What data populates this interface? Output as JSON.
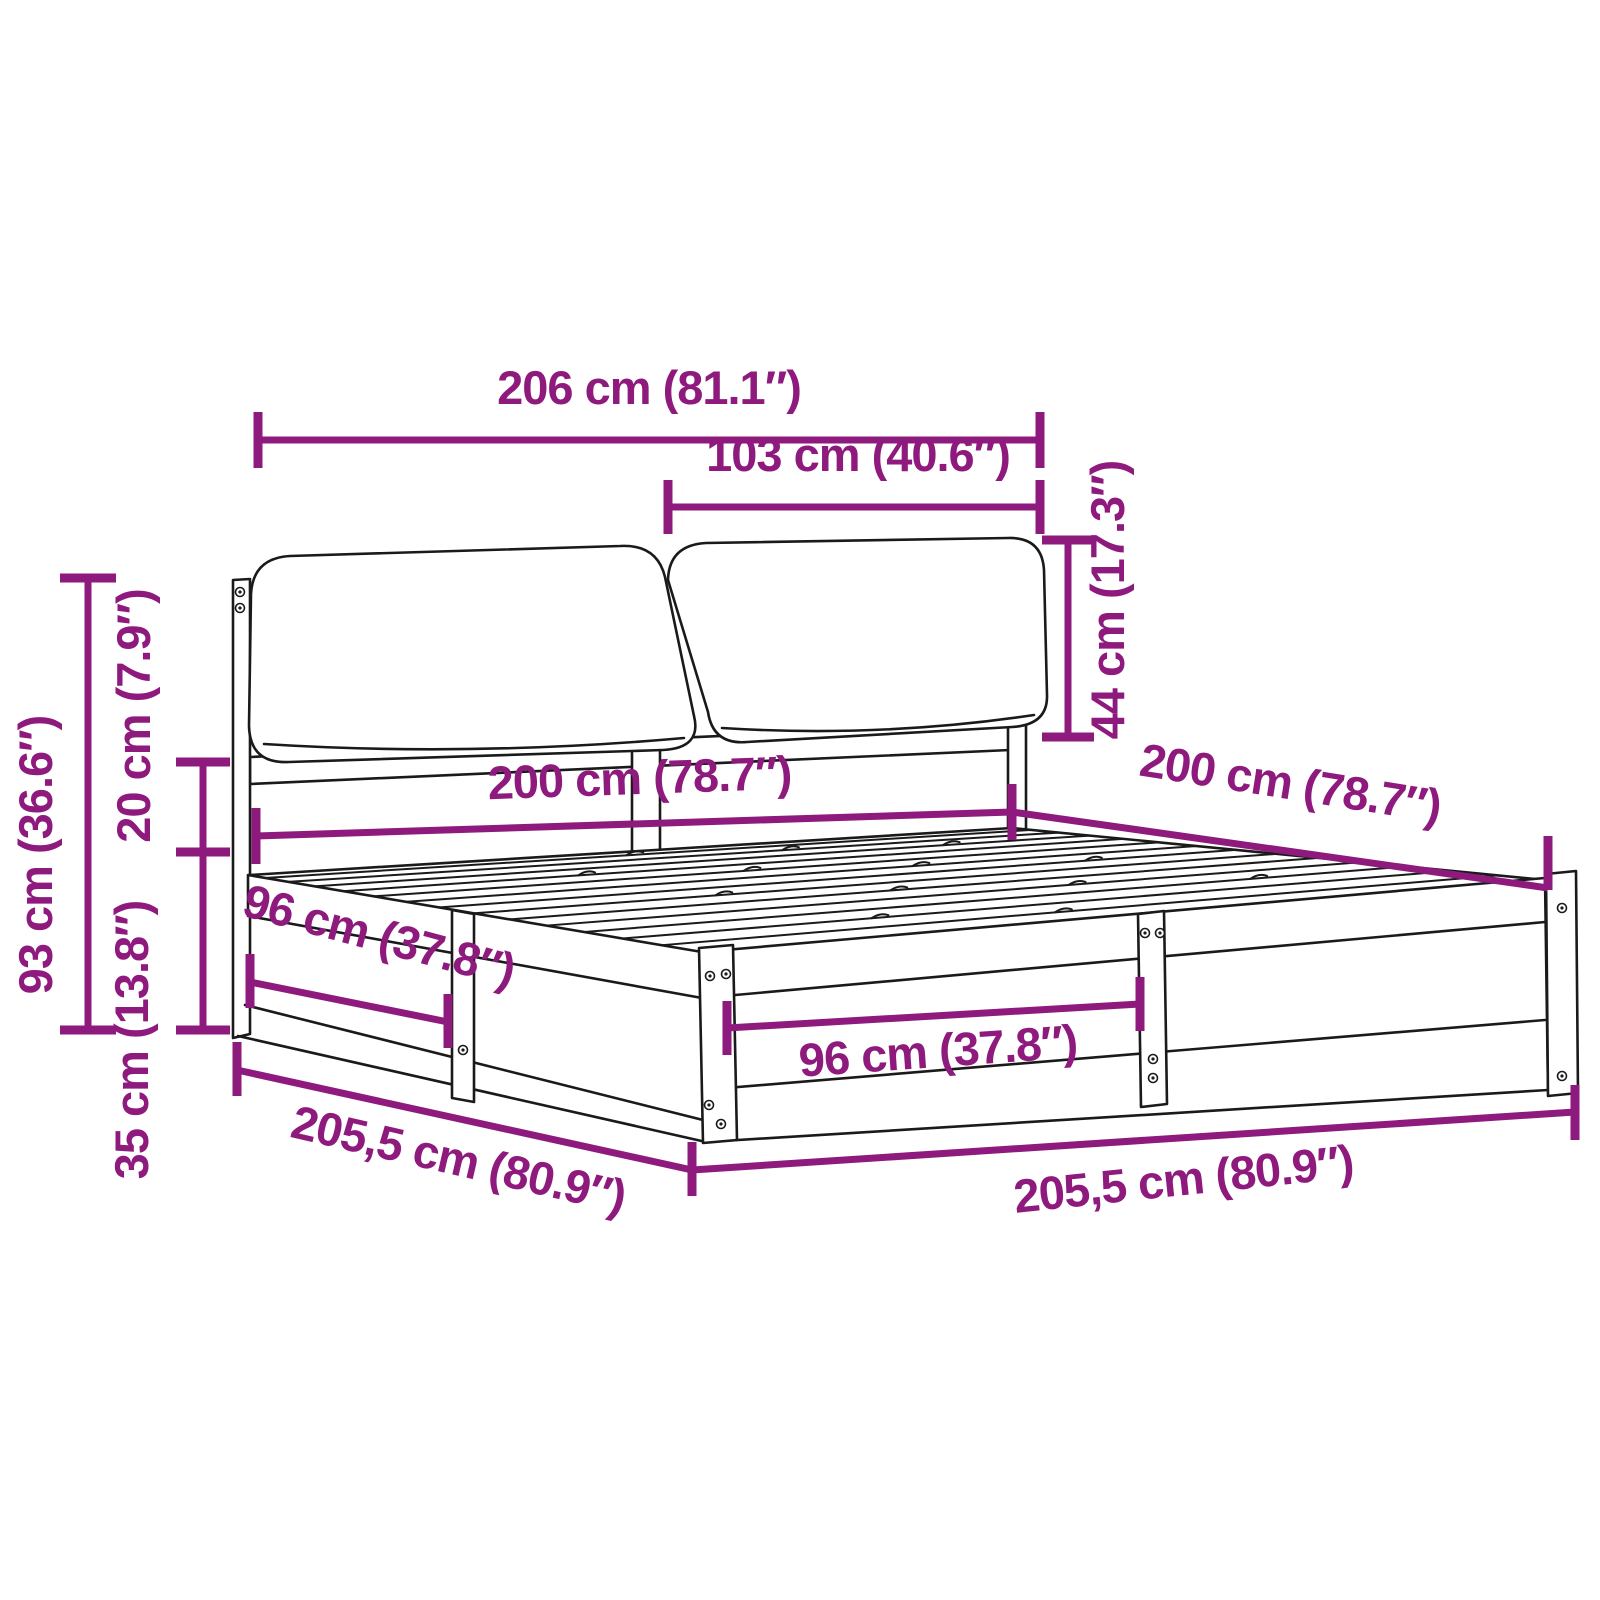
{
  "diagram": {
    "type": "product-dimension-diagram",
    "subject": "bed-frame-with-headboard-cushions",
    "accent_color": "#8E1A7D",
    "line_color": "#1a1a1a",
    "background_color": "#ffffff"
  },
  "labels": {
    "total_width": "206 cm (81.1″)",
    "cushion_width": "103 cm (40.6″)",
    "cushion_height": "44 cm (17.3″)",
    "headboard_height": "93 cm (36.6″)",
    "gap_height": "20 cm (7.9″)",
    "base_height": "35 cm (13.8″)",
    "inner_width": "200 cm (78.7″)",
    "inner_length": "200 cm (78.7″)",
    "side_opening": "96 cm (37.8″)",
    "front_opening": "96 cm (37.8″)",
    "outer_length_side": "205,5 cm (80.9″)",
    "outer_length_front": "205,5 cm (80.9″)"
  }
}
